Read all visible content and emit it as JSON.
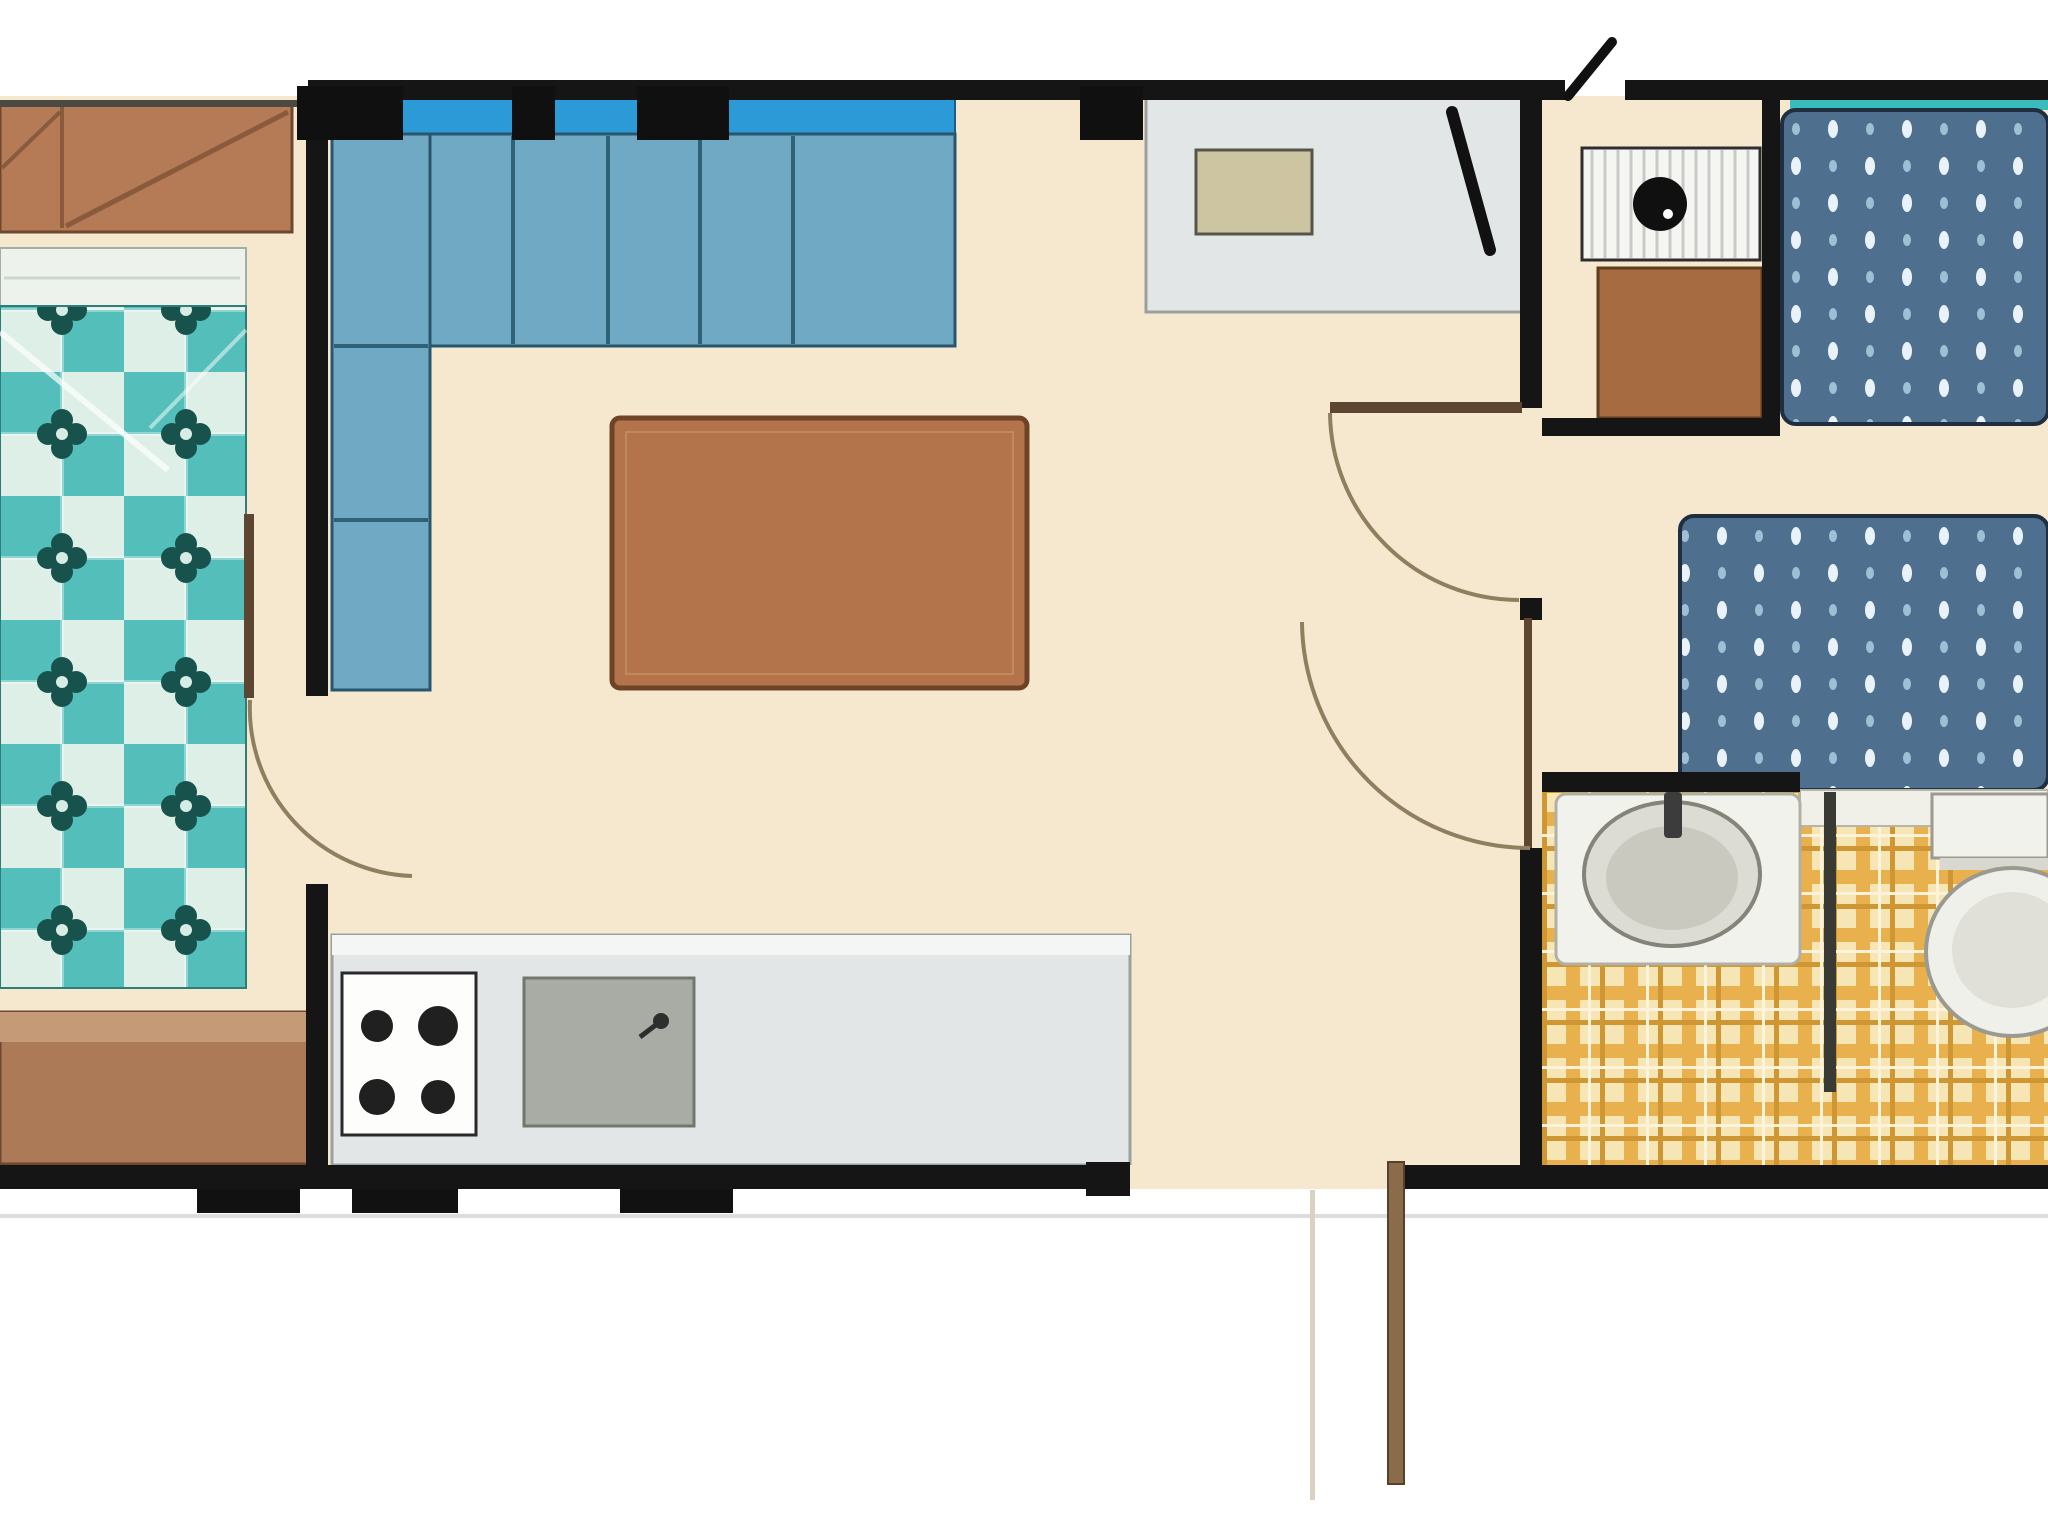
{
  "app": {
    "type": "floorplan",
    "subject": "static-caravan-holiday-home-floor-plan",
    "view": "top-down",
    "visible_text": "none"
  },
  "colors": {
    "background": "#ffffff",
    "floor": "#f5e8cf",
    "wall": "#151515",
    "wall_thin": "#4a4a42",
    "window_black": "#101010",
    "window_teal": "#38bcbc",
    "sofa_back": "#2b9ad6",
    "sofa_seat": "#6fa9c4",
    "sofa_line": "#2f6277",
    "table": "#b3744c",
    "table_border": "#6f4426",
    "wardrobe": "#b57b57",
    "wardrobe_line": "#8a5a3c",
    "chest": "#ad7a58",
    "chest_top": "#c59a76",
    "pillow": "#eef2ec",
    "quilt_teal": "#54bfba",
    "quilt_light": "#ddefe7",
    "quilt_flower": "#17524c",
    "counter": "#e3e6e7",
    "counter_edge": "#9aa0a0",
    "hob_white": "#fdfdfb",
    "burner": "#202020",
    "sink": "#a9aca4",
    "cabinet_beige": "#cdc5a2",
    "cabinet_brown": "#a76b42",
    "white_cabinet": "#f5f5f2",
    "appliance_dot": "#101010",
    "bed_base": "#4e6f8e",
    "bed_dot": "#e8f2f8",
    "bed_dot_dim": "#9fc0d4",
    "bed_border": "#1f2f3f",
    "tartan_base": "#f6e6b6",
    "tartan_stripe": "#e9b04e",
    "tartan_thin": "#cf9733",
    "tartan_light": "#fdf3da",
    "fixture": "#f2f2ec",
    "fixture_edge": "#9a9a90",
    "basin": "#dcdcd4",
    "basin_inner": "#c9c9bf",
    "door_leaf": "#5c4631",
    "door_arc": "#8f7f5f",
    "entry_door": "#8a6b4a",
    "ground_line": "#dddddd"
  },
  "rooms": [
    {
      "name": "master-bedroom",
      "position": "far-left",
      "furniture": [
        "overhead-wardrobe",
        "double-bed-checkered-quilt",
        "chest-of-drawers"
      ]
    },
    {
      "name": "lounge-diner",
      "position": "center-left",
      "furniture": [
        "l-shaped-corner-sofa",
        "coffee-table"
      ]
    },
    {
      "name": "kitchen",
      "position": "center-bottom",
      "furniture": [
        "worktop-run",
        "four-burner-hob",
        "sink-with-tap",
        "top-wall-cabinet-with-beige-front"
      ]
    },
    {
      "name": "hallway",
      "position": "center-right",
      "features": [
        "open-entrance-door-bottom",
        "door-to-twin-bedroom",
        "door-to-bathroom"
      ]
    },
    {
      "name": "storage-cupboard",
      "position": "top-right",
      "furniture": [
        "appliance-unit-black-dot",
        "brown-cabinet"
      ]
    },
    {
      "name": "twin-bedroom",
      "position": "right",
      "furniture": [
        "single-bed-top",
        "single-bed-bottom"
      ]
    },
    {
      "name": "bathroom",
      "position": "bottom-right",
      "floor": "tartan",
      "furniture": [
        "vanity-wash-basin",
        "toilet-with-cistern"
      ]
    }
  ],
  "openings": {
    "windows_top_wall": 4,
    "teal_window_strip_over_top_bed": 1,
    "internal_doors_with_swing_arcs": 3,
    "entrance_door_state": "open-outward"
  }
}
